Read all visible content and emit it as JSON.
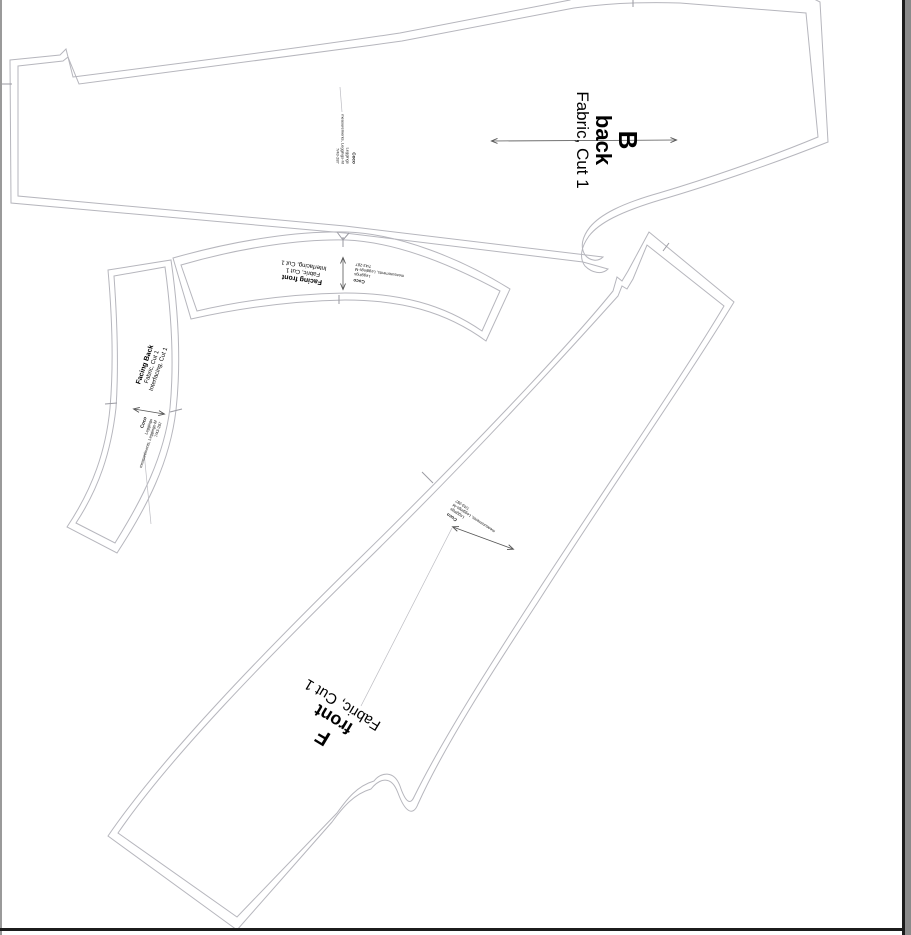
{
  "stamp": {
    "brand": "Coco",
    "line2": "Leggings",
    "line3": "measurements, Leggings-M",
    "line4": "7/43-287"
  },
  "labels": {
    "back": {
      "letter": "B",
      "piece": "back",
      "cut": "Fabric, Cut 1"
    },
    "front": {
      "letter": "F",
      "piece": "front",
      "cut": "Fabric, Cut 1"
    },
    "facing_front": {
      "piece": "Facing front",
      "cut": "Fabric, Cut 1",
      "interfacing": "Interfacing, Cut 1"
    },
    "facing_back": {
      "piece": "Facing Back",
      "cut": "Fabric, Cut 1",
      "interfacing": "Interfacing, Cut 1"
    }
  },
  "colors": {
    "outline": "#b6b6bd",
    "text": "#000000",
    "grainline": "#555555",
    "page_edge_black": "#1c1c1c",
    "page_edge_gray": "#8a8a8a"
  }
}
